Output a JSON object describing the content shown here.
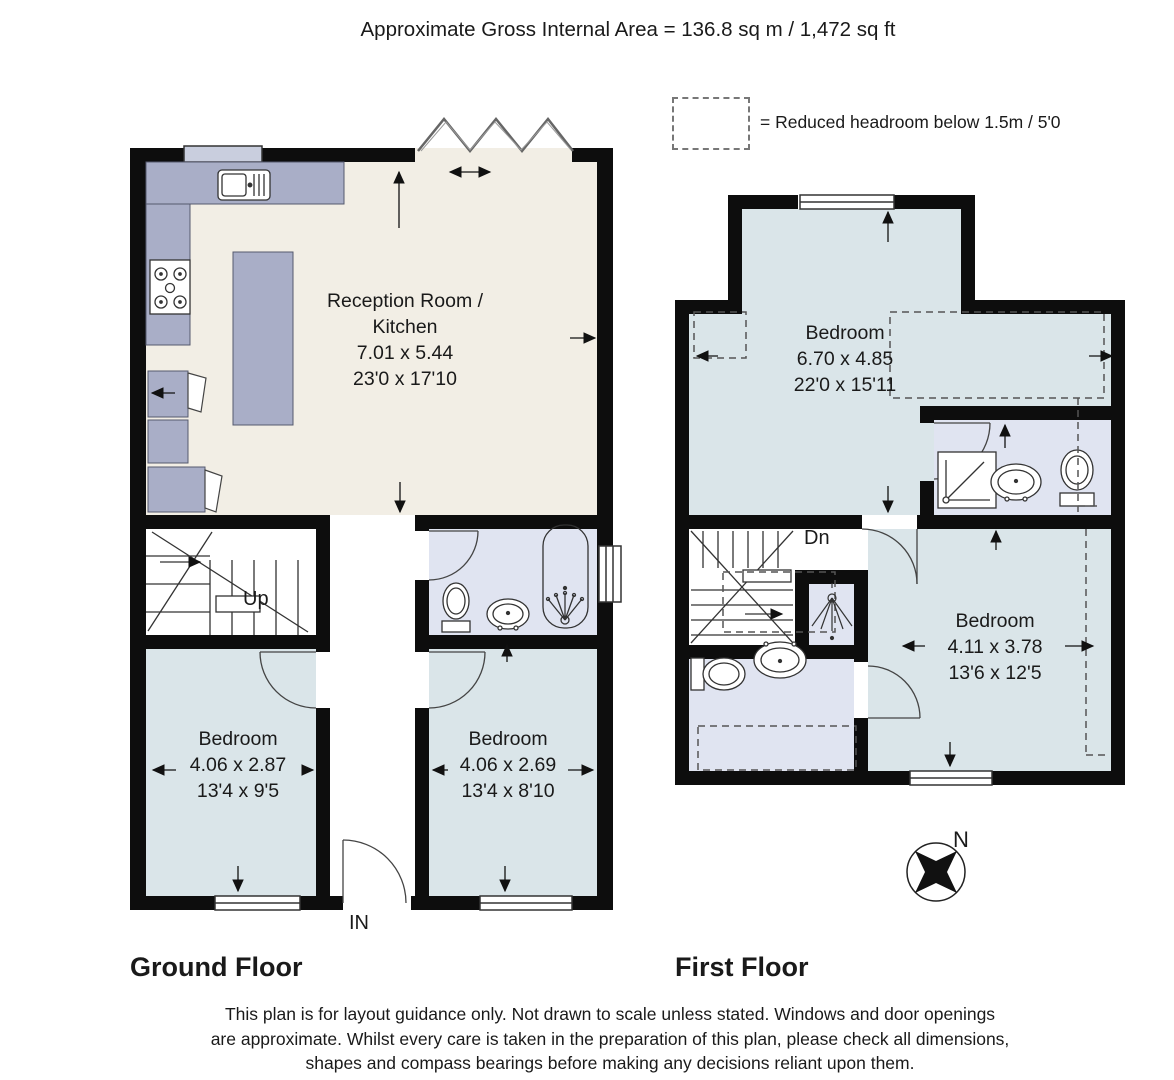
{
  "header": {
    "title": "Approximate Gross Internal Area = 136.8 sq m / 1,472 sq ft"
  },
  "legend": {
    "text": "= Reduced headroom below 1.5m / 5'0"
  },
  "floors": {
    "ground": {
      "title": "Ground Floor",
      "entrance_label": "IN",
      "stairs_label": "Up",
      "rooms": {
        "reception_kitchen": {
          "name": "Reception Room / Kitchen",
          "metric": "7.01 x 5.44",
          "imperial": "23'0 x 17'10"
        },
        "bedroom_left": {
          "name": "Bedroom",
          "metric": "4.06 x 2.87",
          "imperial": "13'4 x 9'5"
        },
        "bedroom_right": {
          "name": "Bedroom",
          "metric": "4.06 x 2.69",
          "imperial": "13'4 x 8'10"
        }
      }
    },
    "first": {
      "title": "First Floor",
      "stairs_label": "Dn",
      "rooms": {
        "bedroom_main": {
          "name": "Bedroom",
          "metric": "6.70 x 4.85",
          "imperial": "22'0 x 15'11"
        },
        "bedroom_rear": {
          "name": "Bedroom",
          "metric": "4.11 x 3.78",
          "imperial": "13'6 x 12'5"
        }
      }
    }
  },
  "compass": {
    "north_label": "N"
  },
  "disclaimer": {
    "line1": "This plan is for layout guidance only. Not drawn to scale unless stated. Windows and door openings",
    "line2": "are approximate. Whilst every care is taken in the preparation of this plan, please check all dimensions,",
    "line3": "shapes and compass bearings before making any decisions reliant upon them."
  },
  "colors": {
    "wall": "#0d0d0d",
    "reception_fill": "#f2eee5",
    "bedroom_fill": "#dae5e9",
    "bathroom_fill": "#e0e4f1",
    "counter_fill": "#a9aec7"
  }
}
